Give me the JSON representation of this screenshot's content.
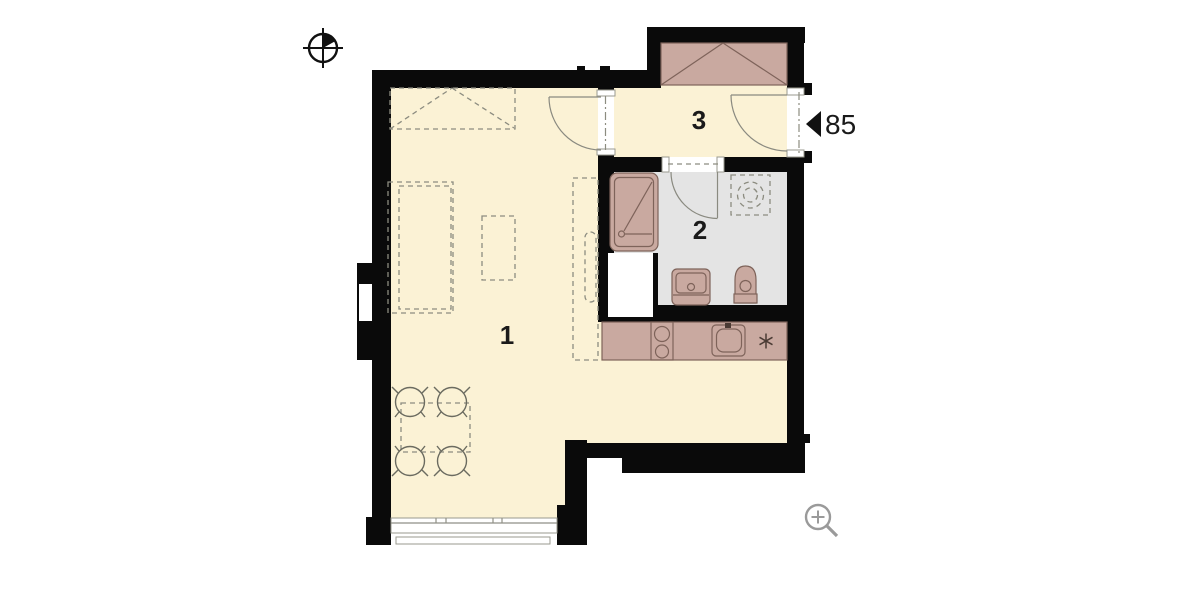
{
  "title": "apartment-floor-plan",
  "rooms": [
    {
      "number": "1"
    },
    {
      "number": "2"
    },
    {
      "number": "3"
    }
  ],
  "annotations": {
    "entrance_door_width": "85"
  },
  "icons": {
    "compass": "north-compass-icon",
    "magnifier": "zoom-in-icon"
  },
  "colors": {
    "floor": "#FBF2D5",
    "bath-floor": "#E4E4E4",
    "furniture": "#C9A9A0",
    "furniture-stroke": "#7E635A",
    "wall": "#0A0A0A",
    "dash": "#8C8C80",
    "outline": "#8A8A80",
    "label": "#1A1A1A",
    "icon-gray": "#9A9A9A"
  }
}
